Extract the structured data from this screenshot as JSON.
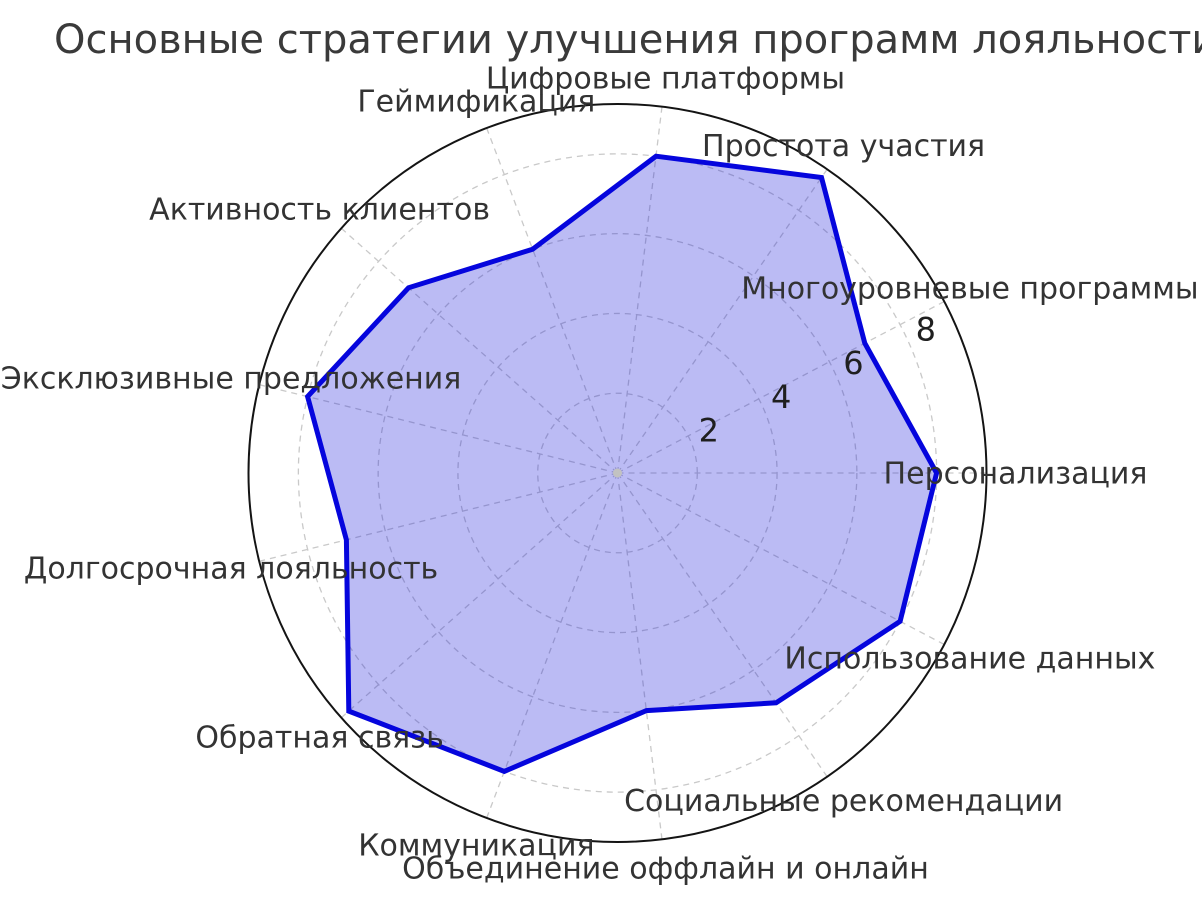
{
  "chart_data": {
    "type": "radar",
    "title": "Основные стратегии улучшения программ лояльности",
    "categories": [
      "Персонализация",
      "Многоуровневые программы",
      "Простота участия",
      "Цифровые платформы",
      "Геймификация",
      "Активность клиентов",
      "Эксклюзивные предложения",
      "Долгосрочная лояльность",
      "Обратная связь",
      "Коммуникация",
      "Объединение оффлайн и онлайн",
      "Социальные рекомендации",
      "Использование данных"
    ],
    "values": [
      8,
      7,
      9,
      8,
      6,
      7,
      8,
      7,
      9,
      8,
      6,
      7,
      8
    ],
    "r_ticks": [
      "2",
      "4",
      "6",
      "8"
    ],
    "r_tick_values": [
      2,
      4,
      6,
      8
    ],
    "r_max": 9.25,
    "start_angle_deg": 0,
    "direction": "counterclockwise",
    "grid": true,
    "legend": false,
    "colors": {
      "line": "#0505dd",
      "fill": "rgba(30,30,220,0.30)",
      "grid": "#c9c9c9",
      "outer_ring": "#141414",
      "tick_text": "#1f1f1f",
      "label_text": "#333333",
      "title_text": "#3a3a3a",
      "center_dot": "#c2c2c2"
    }
  }
}
